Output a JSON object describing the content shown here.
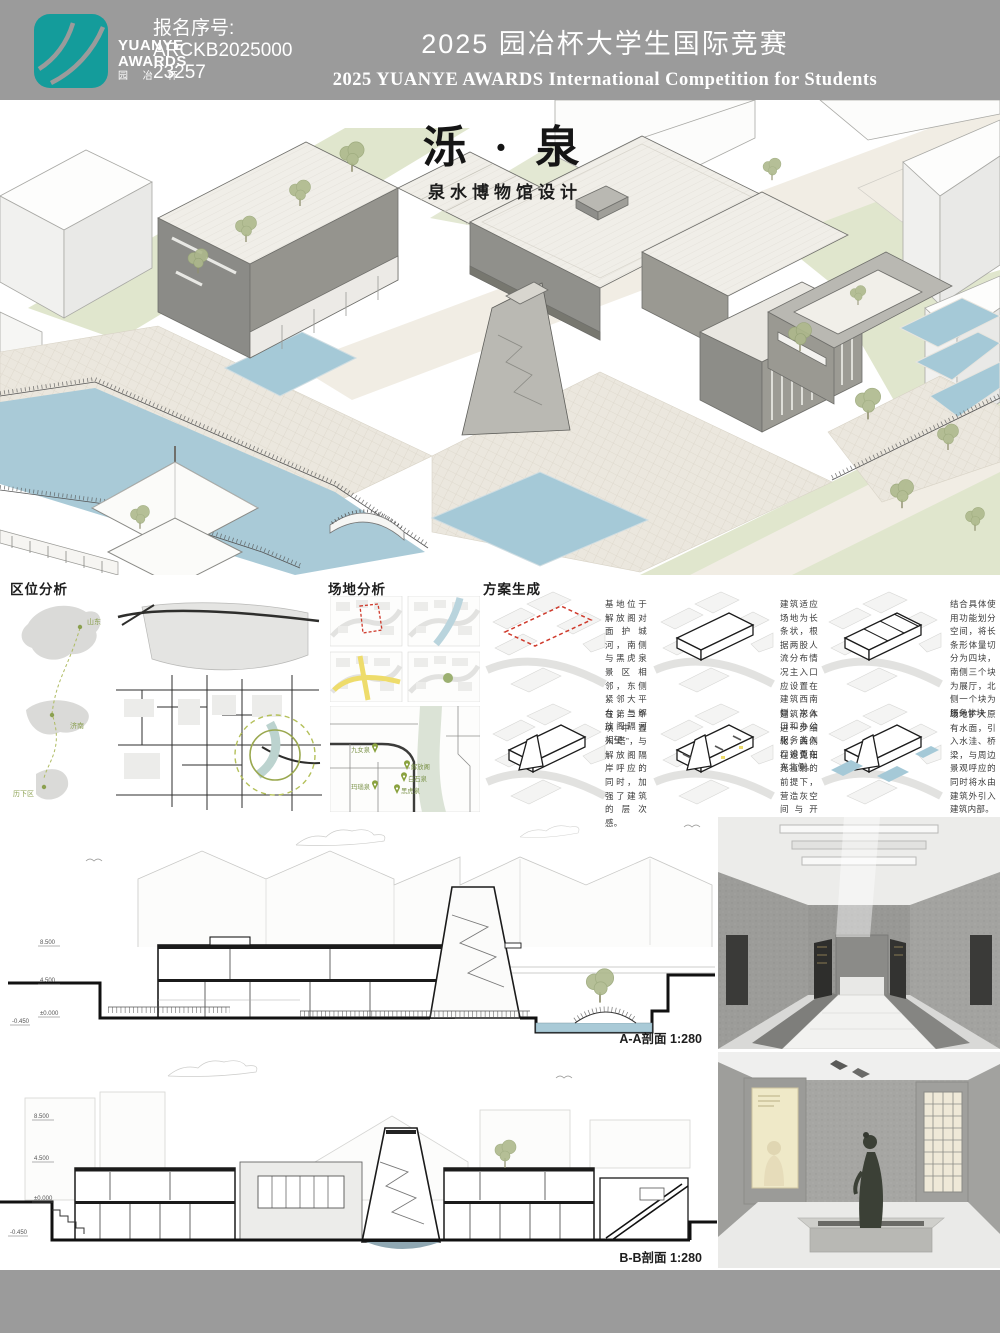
{
  "header": {
    "logo": {
      "line1": "YUANYE",
      "line2": "AWARDS",
      "line3": "园 冶 杯"
    },
    "reg_label": "报名序号:",
    "reg_line1": "ARCKB2025000",
    "reg_line2": "23257",
    "title_cn": "2025 园冶杯大学生国际竞赛",
    "title_en": "2025 YUANYE AWARDS International Competition for  Students"
  },
  "hero": {
    "project_title": "泺 · 泉",
    "project_subtitle": "泉水博物馆设计"
  },
  "analysis": {
    "location": {
      "heading": "区位分析",
      "labels": [
        "山东",
        "济南",
        "历下区"
      ]
    },
    "site": {
      "heading": "场地分析",
      "pins": [
        "九女泉",
        "解放阁",
        "白石泉",
        "玛瑙泉",
        "黑虎泉"
      ]
    },
    "scheme": {
      "heading": "方案生成",
      "steps": [
        "基地位于解放阁对面护城河，南侧与黑虎泉景区相邻，东侧紧邻大平台，与解放阁隔河相望",
        "建筑适应场地为长条状，根据两股人流分布情况主入口应设置在建筑西南侧，次入口和办公服务类入口设置在东北侧。",
        "结合具体使用功能划分空间，将长条形体量切分为四块，南侧三个块为展厅，北侧一个块为服务体块",
        "在第二个块中置入“塔”，与解放阁隔岸呼应的同时，加强了建筑的层次感。",
        "建筑形体进一步细化，西侧在避免阳光直射的前提下，营造灰空间与开窗，使建筑与解放阁有更深层次的交流",
        "场地扩大原有水面，引入水洼、桥梁，与周边景观呼应的同时将水由建筑外引入建筑内部。"
      ]
    }
  },
  "sections": {
    "aa_label": "A-A剖面 1:280",
    "bb_label": "B-B剖面 1:280",
    "levels": [
      "8.500",
      "4.500",
      "±0.000",
      "-0.450"
    ]
  },
  "colors": {
    "header_bar": "#9b9b9b",
    "logo_teal": "#149c9b",
    "water": "#a9cad7",
    "lawn": "#e0e6cd",
    "museum_wall": "#8b8b87",
    "accent_red": "#cf3a2c",
    "accent_yellow": "#eedc6b",
    "accent_olive": "#9aa84f"
  }
}
